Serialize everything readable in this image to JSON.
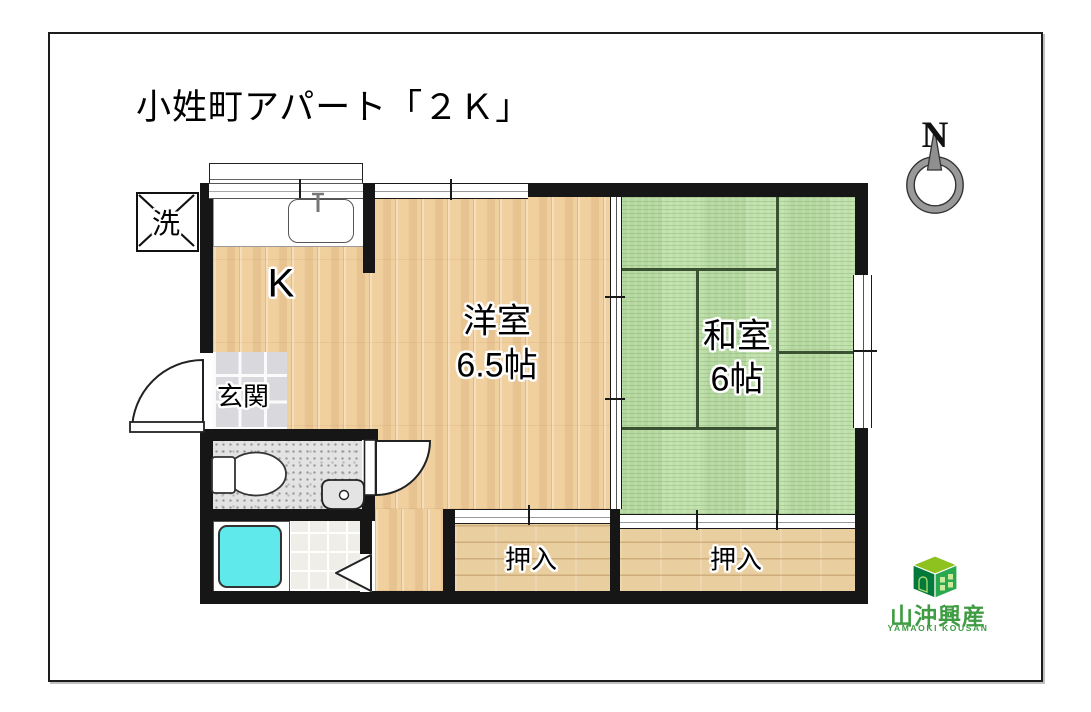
{
  "page": {
    "title": "小姓町アパート「２Ｋ」"
  },
  "compass": {
    "label": "N"
  },
  "floorplan": {
    "rooms": [
      {
        "id": "kitchen",
        "label": "K"
      },
      {
        "id": "western-room",
        "label": "洋室",
        "size": "6.5帖"
      },
      {
        "id": "japanese-room",
        "label": "和室",
        "size": "6帖"
      },
      {
        "id": "entrance",
        "label": "玄関"
      },
      {
        "id": "closet-left",
        "label": "押入"
      },
      {
        "id": "closet-right",
        "label": "押入"
      },
      {
        "id": "laundry",
        "label": "洗"
      }
    ]
  },
  "logo": {
    "company": "山沖興産",
    "romaji": "YAMAOKI KOUSAN"
  },
  "colors": {
    "wall": "#161616",
    "wood_floor": "#F1D0A0",
    "tatami_green": "#C0E0AB",
    "closet_wood": "#E9CE9F",
    "bathtub_cyan": "#5FE9EB",
    "logo_green": "#3F9C43",
    "compass_gray": "#999999"
  }
}
